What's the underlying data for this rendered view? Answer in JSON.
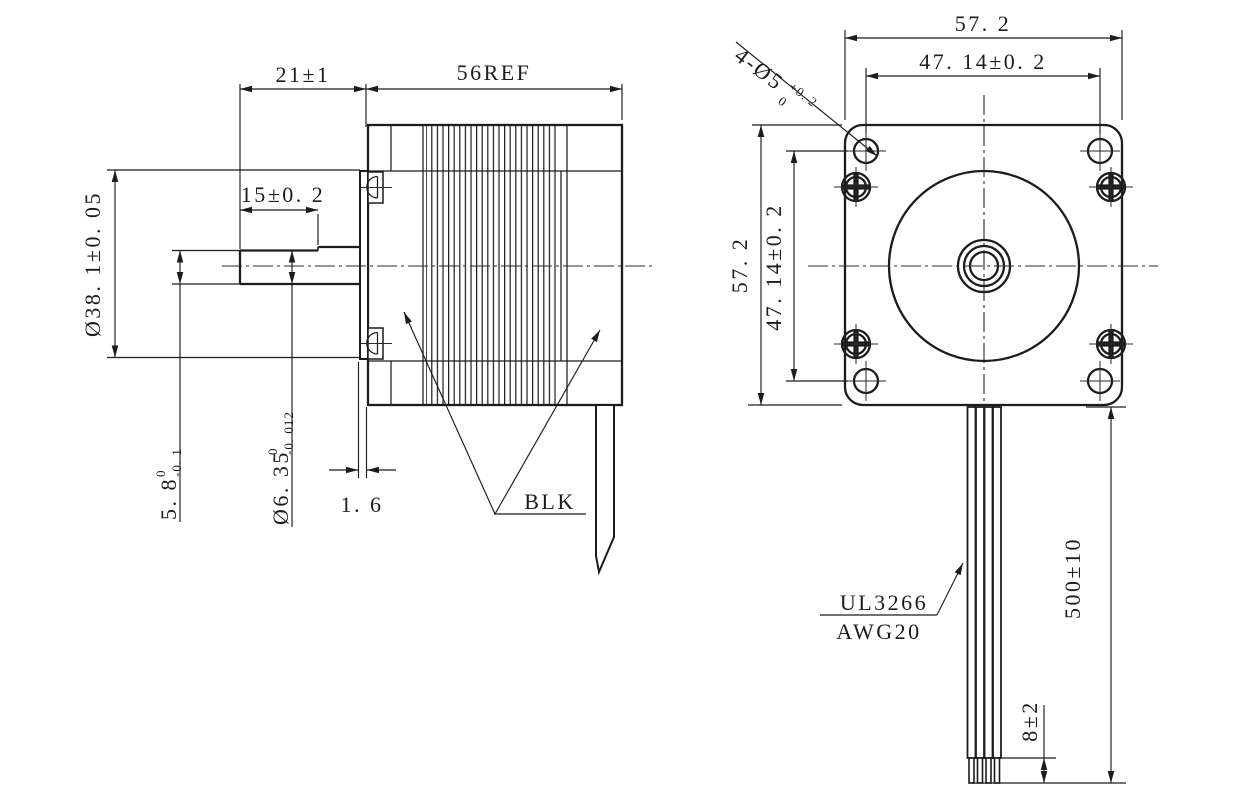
{
  "drawing": {
    "type": "stepper-motor-outline-drawing",
    "side_view": {
      "dim_shaft_extension": "21±1",
      "dim_body_length": "56REF",
      "dim_flat_length": "15±0. 2",
      "dim_pilot_diameter": "Ø38. 1±0. 05",
      "dim_flat_height": {
        "main": "5. 8",
        "tol_upper": "0",
        "tol_lower": "-0. 1"
      },
      "dim_shaft_diameter": {
        "main": "Ø6. 35",
        "tol_upper": "0",
        "tol_lower": "-0. 012"
      },
      "dim_pilot_thickness": "1. 6",
      "label_color": "BLK"
    },
    "front_view": {
      "dim_width": "57. 2",
      "dim_hole_spacing_horizontal": "47. 14±0. 2",
      "dim_height": "57. 2",
      "dim_hole_spacing_vertical": "47. 14±0. 2",
      "label_mounting_holes": {
        "main": "4-Ø5",
        "tol_upper": "+0. 2",
        "tol_lower": "0"
      },
      "dim_lead_length": "500±10",
      "dim_strip_length": "8±2",
      "wire_spec_line1": "UL3266",
      "wire_spec_line2": "AWG20"
    },
    "colors": {
      "line": "#1c1c1c",
      "background": "#ffffff"
    }
  }
}
